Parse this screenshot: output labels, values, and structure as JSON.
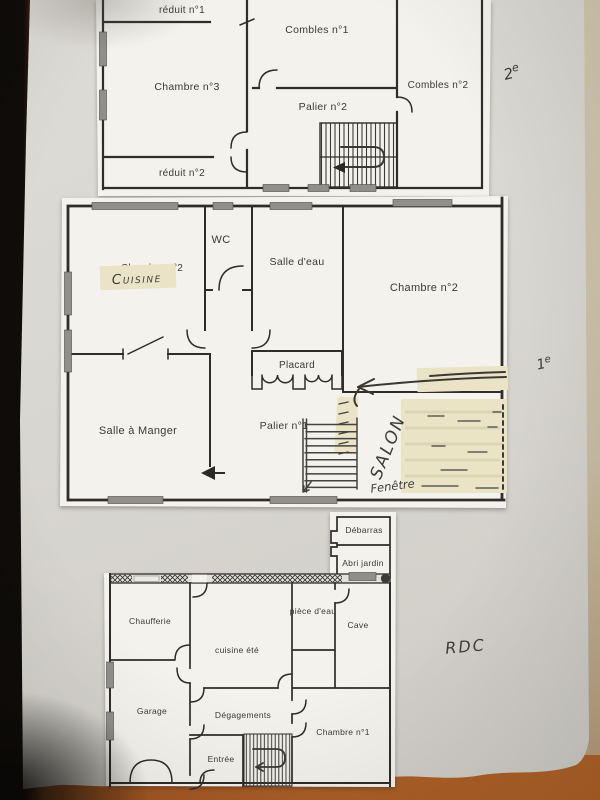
{
  "colors": {
    "table_wood": "#9c5320",
    "paper_background": "#d9d7d1",
    "plan_sheet": "#f3f2ed",
    "wall_ink": "#2e2d2a",
    "correction_tape": "#eae3c6",
    "handwriting_ink": "#403e3a",
    "window_marker_gray": "#908f8b",
    "dark_left_edge": "#0f0c09",
    "right_edge_strip": "#c9bfa5"
  },
  "floors": {
    "second": {
      "annotation": {
        "base": "2",
        "sup": "e"
      },
      "rooms": {
        "reduit1": "réduit n°1",
        "combles1": "Combles n°1",
        "chambre3": "Chambre n°3",
        "combles2": "Combles n°2",
        "palier2": "Palier n°2",
        "reduit2": "réduit n°2"
      }
    },
    "first": {
      "annotation": {
        "base": "1",
        "sup": "e"
      },
      "rooms": {
        "wc": "WC",
        "salle_deau": "Salle d'eau",
        "chambre2": "Chambre n°2",
        "placard": "Placard",
        "salle_a_manger": "Salle à Manger",
        "palier1": "Palier n°1"
      },
      "handwritten": {
        "cuisine": "Cuisine",
        "salon": "SALON",
        "fenetre": "Fenêtre"
      },
      "covered_text": "Chambre n°2"
    },
    "ground": {
      "annotation": {
        "base": "RDC",
        "sup": ""
      },
      "rooms": {
        "debarras": "Débarras",
        "abri_jardin": "Abri jardin",
        "chaufferie": "Chaufferie",
        "cuisine_ete": "cuisine été",
        "piece_deau": "pièce d'eau",
        "cave": "Cave",
        "garage": "Garage",
        "degagements": "Dégagements",
        "entree": "Entrée",
        "chambre1": "Chambre n°1"
      }
    }
  }
}
